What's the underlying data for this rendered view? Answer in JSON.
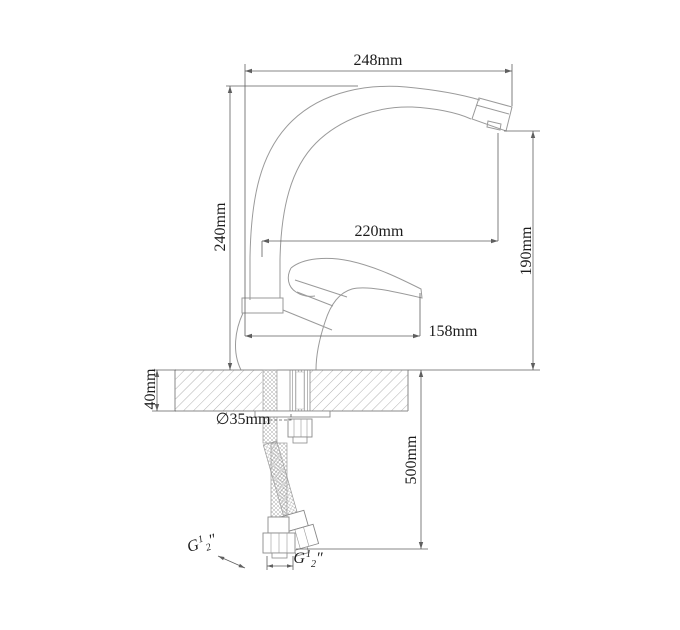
{
  "drawing": {
    "type": "technical-dimension-drawing",
    "subject": "single-lever kitchen faucet side view with mounting and supply hoses",
    "labels": {
      "spout_width": "248mm",
      "spout_height": "240mm",
      "spout_reach": "220mm",
      "outlet_height": "190mm",
      "handle_reach": "158mm",
      "deck_thickness": "40mm",
      "hole_diameter": "∅35mm",
      "hose_length": "500mm"
    },
    "thread_labels": {
      "left": {
        "letter": "G",
        "numerator": "1",
        "denominator": "2",
        "unit": "″"
      },
      "right": {
        "letter": "G",
        "numerator": "1",
        "denominator": "2",
        "unit": "″"
      }
    },
    "colors": {
      "background": "#ffffff",
      "outline": "#9a9a9a",
      "fixture": "#8a8a8a",
      "dimension": "#5f5f5f",
      "hatch": "#a8a8a8",
      "text": "#1c1c1c"
    }
  }
}
